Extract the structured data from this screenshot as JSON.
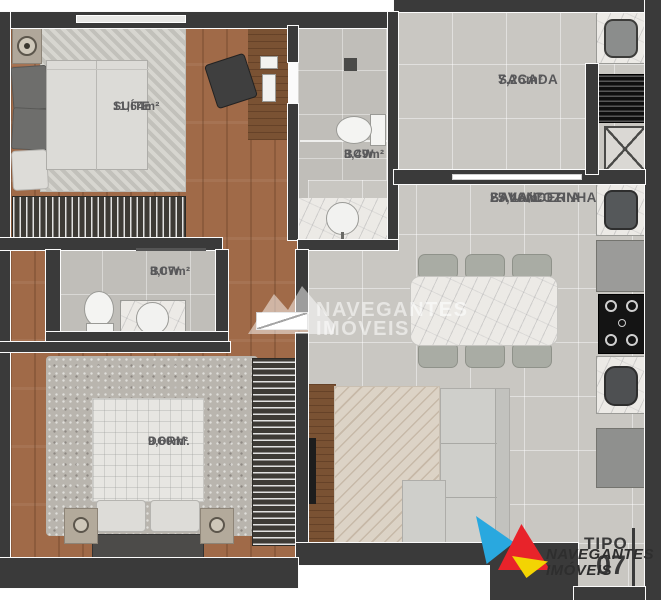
{
  "rooms": {
    "suite": {
      "name": "SUÍTE",
      "area": "11,64m²"
    },
    "sacada": {
      "name": "SACADA",
      "area": "7,26m²"
    },
    "bcw_suite": {
      "name": "BCW",
      "area": "3,49m²"
    },
    "sala": {
      "line1": "SALA/COZINHA",
      "line2": "LAVANDERIA",
      "area": "25,46m²"
    },
    "bcw_social": {
      "name": "BCW",
      "area": "3,07m²"
    },
    "dorm": {
      "name": "DORM.",
      "area": "9,60m²"
    }
  },
  "watermark": {
    "line1": "NAVEGANTES",
    "line2": "IMÓVEIS"
  },
  "brand": {
    "line1": "NAVEGANTES",
    "line2": "IMÓVEIS"
  },
  "unit": {
    "type_label": "TIPO",
    "type_number": "07"
  },
  "colors": {
    "wall": "#3a3a3a",
    "wood": "#a06a48",
    "tile": "#c9c7c2",
    "marble": "#eceae6",
    "label_text": "#58585a",
    "logo_cyan": "#29a8df",
    "logo_red": "#e8232a",
    "logo_yellow": "#f3d403"
  }
}
